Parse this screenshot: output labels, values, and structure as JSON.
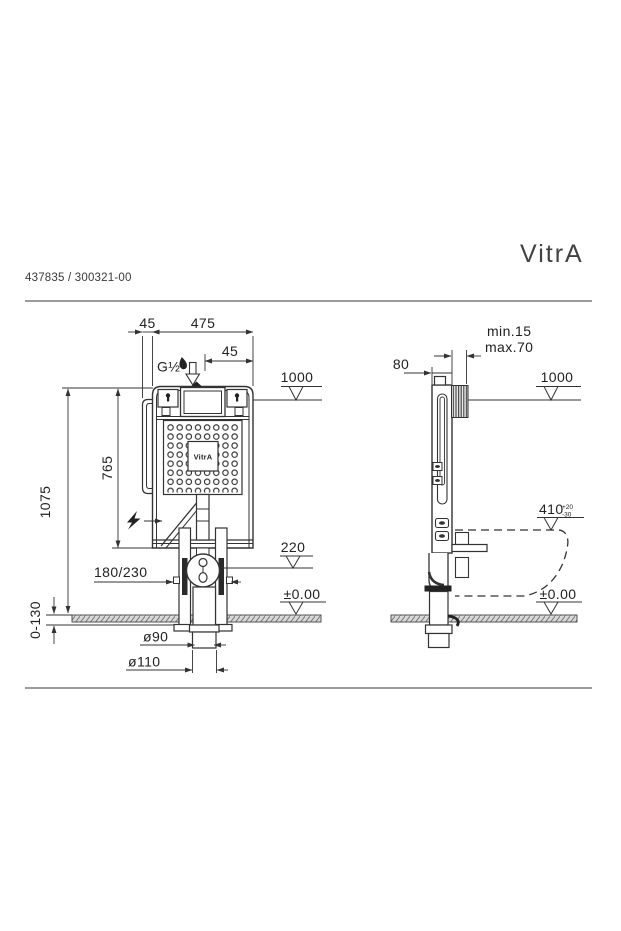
{
  "document": {
    "part_number": "437835 / 300321-00",
    "brand_logo": "VitrA"
  },
  "front_view": {
    "tank_label": "VitrA",
    "inlet_thread": "G½",
    "dim_offset_top": "45",
    "dim_width": "475",
    "dim_inlet_offset": "45",
    "level_top": "1000",
    "dim_tank_height": "765",
    "dim_frame_height": "1075",
    "dim_fixing_spacing": "180/230",
    "level_flush_bend": "220",
    "level_floor": "±0.00",
    "dim_floor_range": "0-130",
    "dim_outlet_inner": "ø90",
    "dim_outlet_outer": "ø110"
  },
  "side_view": {
    "dim_frame_depth": "80",
    "dim_wall_min": "min.15",
    "dim_wall_max": "max.70",
    "level_top": "1000",
    "dim_pan_outlet_height": "410",
    "dim_pan_outlet_tol_plus": "+20",
    "dim_pan_outlet_tol_minus": "-30",
    "level_floor": "±0.00"
  }
}
